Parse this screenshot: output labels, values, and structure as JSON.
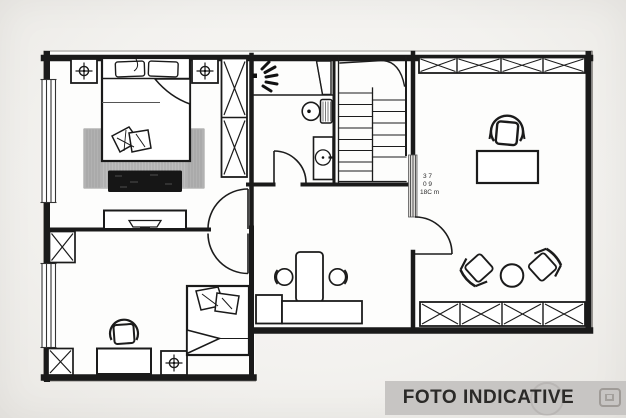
{
  "watermark": {
    "label": "FOTO INDICATIVE"
  },
  "plan": {
    "dim_note": {
      "line1": "3 7",
      "line2": "0 9",
      "line3": "18C m"
    }
  },
  "colors": {
    "background": "#f3f2ef",
    "plan_floor": "#fdfdfc",
    "line": "#1a1a1a",
    "rug": "#c7c7c7",
    "bench": "#161616",
    "banner_bg": "#c7c5c3",
    "banner_text": "#2b2a28"
  }
}
